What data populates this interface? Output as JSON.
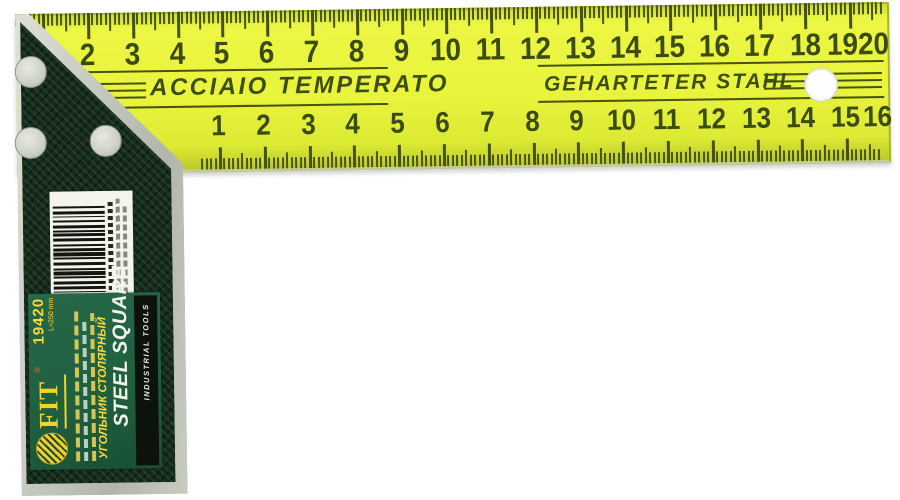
{
  "blade": {
    "left_steel_text": "ACCIAIO TEMPERATO",
    "right_steel_text": "GEHARTETER STAHL",
    "top_scale_numbers": [
      "2",
      "3",
      "4",
      "5",
      "6",
      "7",
      "8",
      "9",
      "10",
      "11",
      "12",
      "13",
      "14",
      "15",
      "16",
      "17",
      "18",
      "19",
      "20"
    ],
    "bottom_scale_numbers": [
      "1",
      "2",
      "3",
      "4",
      "5",
      "6",
      "7",
      "8",
      "9",
      "10",
      "11",
      "12",
      "13",
      "14",
      "15",
      "16"
    ]
  },
  "handle_label": {
    "brand": "FIT",
    "registered_mark": "®",
    "sku": "19420",
    "size_text": "L=250 mm",
    "product_name_ru": "УГОЛЬНИК СТОЛЯРНЫЙ",
    "product_name_en": "STEEL SQUARE",
    "black_bar_text": "INDUSTRIAL TOOLS",
    "barcode_pattern": "2111212211211222112121122121112212112211"
  },
  "colors": {
    "blade_yellow": "#e9f43c",
    "marking_green": "#3c4b10",
    "handle_dark_green": "#152b1c",
    "label_green": "#20603f",
    "metal_gray": "#c7cabf",
    "brand_yellow": "#f2d42a",
    "accent_yellow": "#ffd83a",
    "background": "#ffffff"
  }
}
